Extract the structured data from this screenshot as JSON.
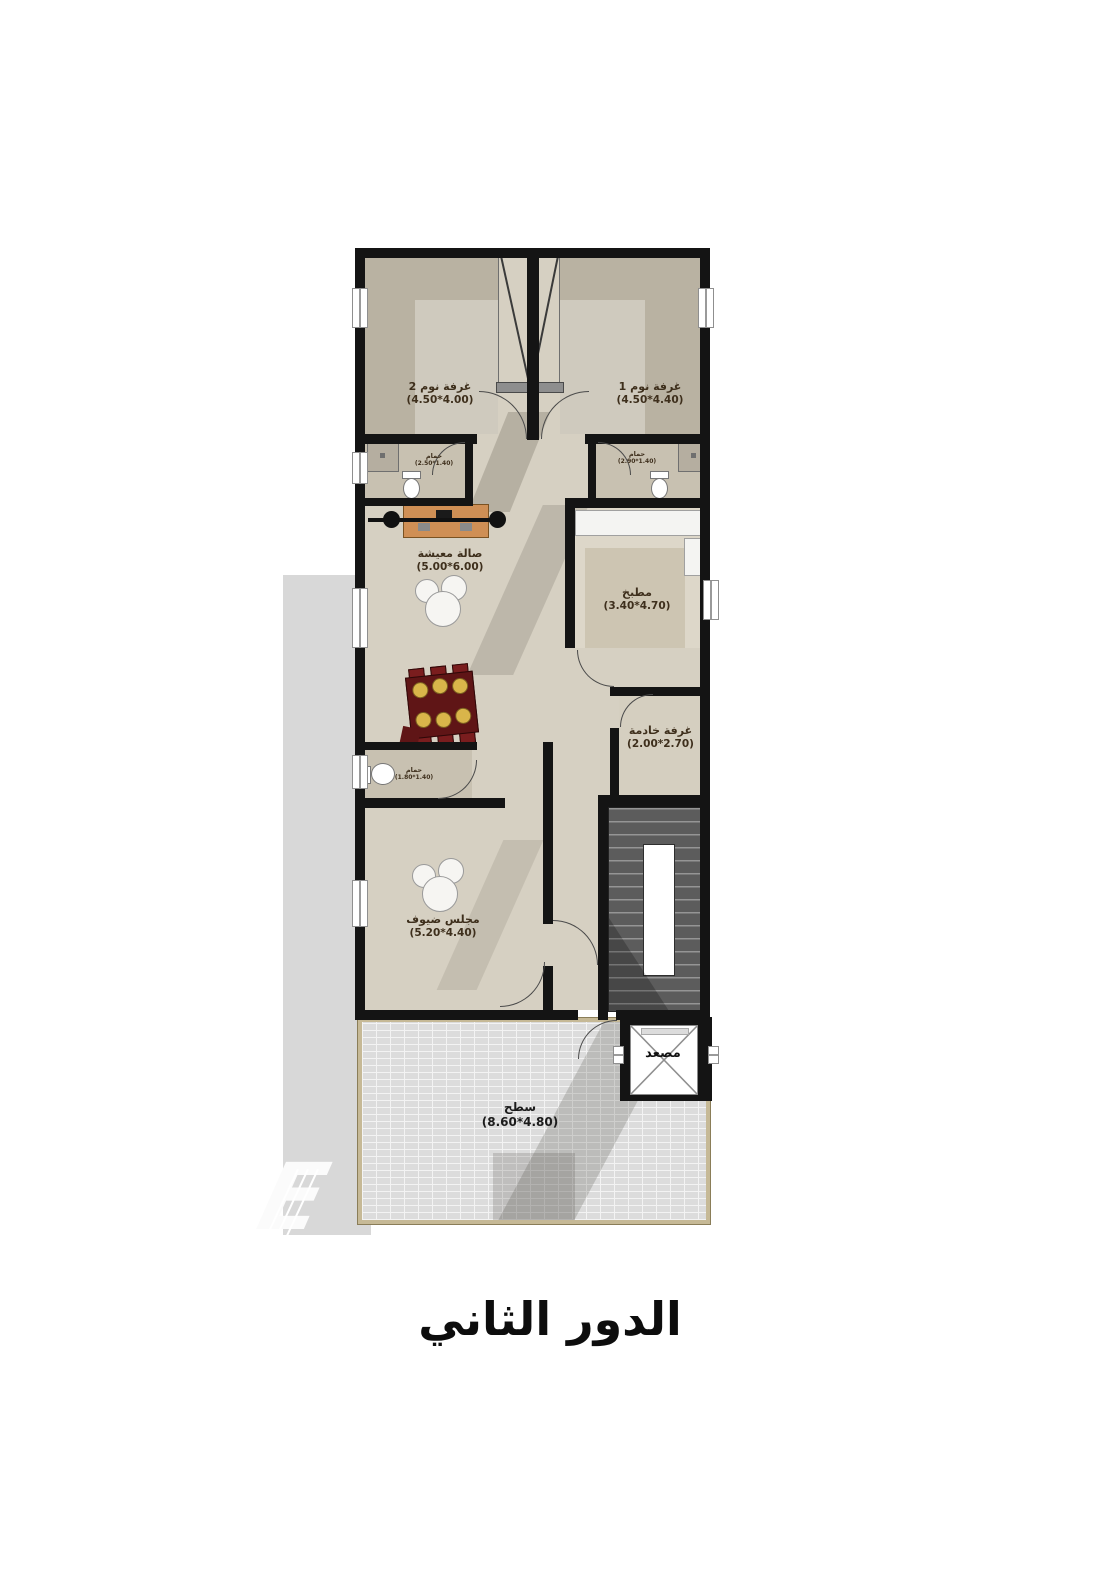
{
  "title": "الدور الثاني",
  "watermark": "E",
  "colors": {
    "wall": "#141414",
    "floor_light": "#d6d0c2",
    "floor_bedroom": "#b9b2a2",
    "floor_bath": "#c8c1b1",
    "wood_accent": "#cf8f55",
    "sofa_brown": "#6f5336",
    "dining_red": "#5f1516",
    "plate_gold": "#d9b54a",
    "terrace_border": "#c6b996",
    "gray_panel": "#d8d8d8"
  },
  "rooms": [
    {
      "name": "غرفة نوم 2",
      "dim": "(4.50*4.00)"
    },
    {
      "name": "غرفة نوم 1",
      "dim": "(4.50*4.40)"
    },
    {
      "name": "حمام",
      "dim": "(2.50*1.40)"
    },
    {
      "name": "حمام",
      "dim": "(2.90*1.40)"
    },
    {
      "name": "صالة معيشة",
      "dim": "(5.00*6.00)"
    },
    {
      "name": "مطبخ",
      "dim": "(3.40*4.70)"
    },
    {
      "name": "غرفة خادمة",
      "dim": "(2.00*2.70)"
    },
    {
      "name": "حمام",
      "dim": "(1.80*1.40)"
    },
    {
      "name": "مجلس ضيوف",
      "dim": "(5.20*4.40)"
    },
    {
      "name": "سطح",
      "dim": "(8.60*4.80)"
    },
    {
      "name": "مصعد",
      "dim": ""
    }
  ]
}
